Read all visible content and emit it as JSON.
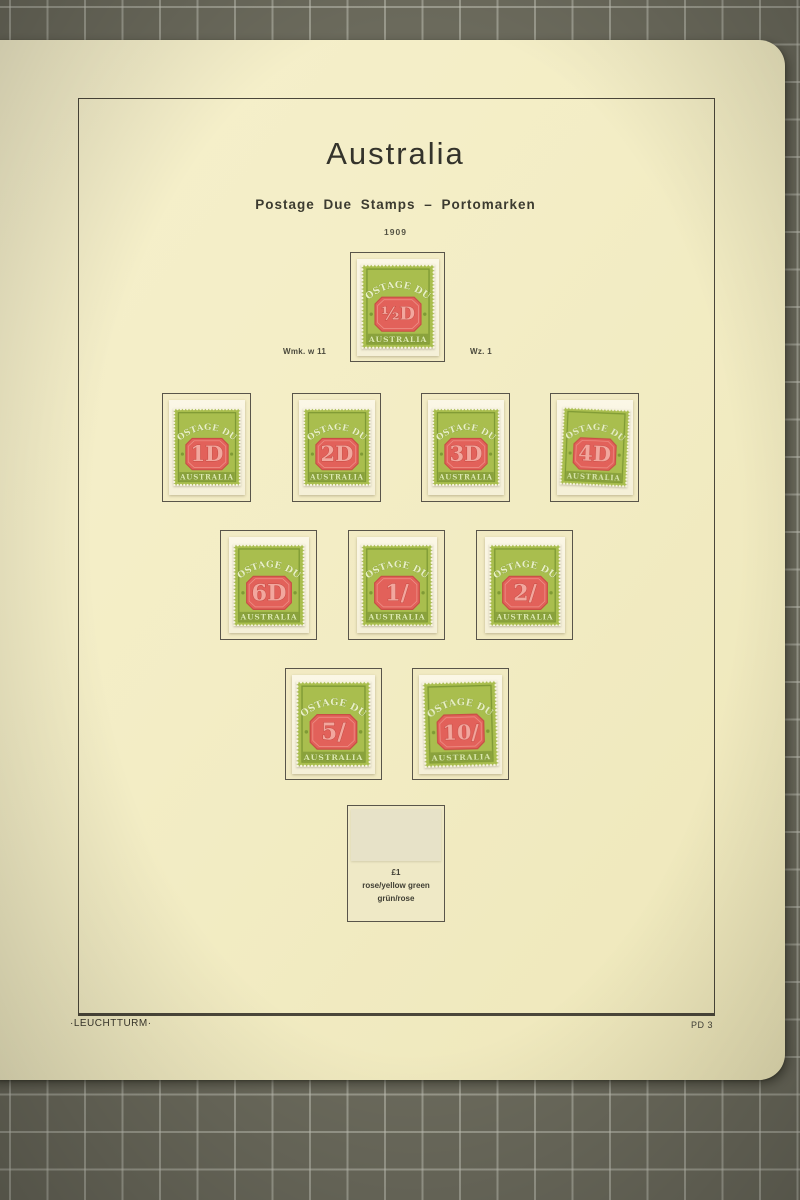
{
  "page": {
    "title": "Australia",
    "subtitle": "Postage Due Stamps – Portomarken",
    "year": "1909",
    "watermark_note_left": "Wmk. w 11",
    "watermark_note_right": "Wz. 1",
    "publisher": "·LEUCHTTURM·",
    "page_number": "PD 3"
  },
  "stamp_text": {
    "top": "POSTAGE DUE",
    "bottom": "AUSTRALIA"
  },
  "stamps": [
    {
      "value": "½D"
    },
    {
      "value": "1D"
    },
    {
      "value": "2D"
    },
    {
      "value": "3D"
    },
    {
      "value": "4D"
    },
    {
      "value": "6D"
    },
    {
      "value": "1/"
    },
    {
      "value": "2/"
    },
    {
      "value": "5/"
    },
    {
      "value": "10/"
    }
  ],
  "empty_slot": {
    "value": "£1",
    "color_en": "rose/yellow green",
    "color_de": "grün/rose"
  },
  "colors": {
    "page_cream": "#f3edc5",
    "mat_olive": "#6b6a5c",
    "stamp_green": "#a9be4e",
    "stamp_band_green": "#8aa23c",
    "stamp_red": "#e2615a",
    "frame_ink": "#4b473a"
  }
}
